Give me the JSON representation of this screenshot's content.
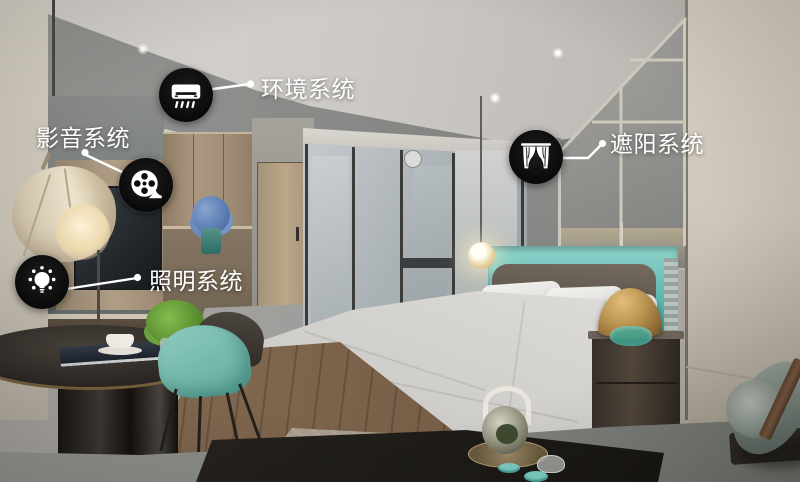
{
  "callouts": [
    {
      "id": "environment",
      "label": "环境系统",
      "icon": "air-conditioner-icon"
    },
    {
      "id": "audio-video",
      "label": "影音系统",
      "icon": "film-reel-icon"
    },
    {
      "id": "shading",
      "label": "遮阳系统",
      "icon": "curtain-icon"
    },
    {
      "id": "lighting",
      "label": "照明系统",
      "icon": "light-bulb-icon"
    }
  ],
  "colors": {
    "badge_background": "#0d0d0d",
    "badge_glyph": "#ffffff",
    "label_text": "#ffffff",
    "leader_line": "#ffffff",
    "accent_teal": "#6cc4bb",
    "lamp_gold": "#b9924f"
  }
}
